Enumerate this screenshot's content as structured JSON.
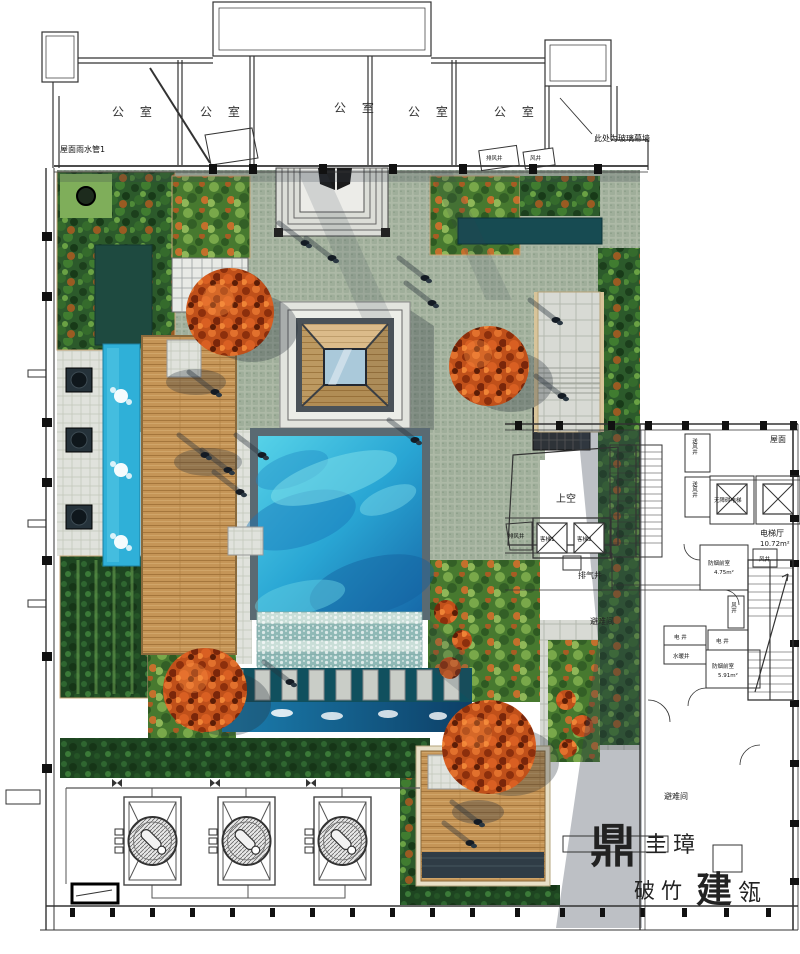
{
  "building_top": {
    "room_labels": [
      "公 室",
      "公 室",
      "公 室",
      "公 室",
      "公 室"
    ],
    "rain_pipe_note": "屋面雨水管1",
    "curtain_wall_note": "此处为玻璃幕墙",
    "vent_box_labels": [
      "排风井",
      "风井"
    ]
  },
  "plan": {
    "roof": "屋面",
    "void": "上空",
    "supply_shafts": [
      "送风井",
      "送风井"
    ],
    "exhaust_shaft": "排风井",
    "exhaust_air": "排气井",
    "elevators": [
      "客梯1",
      "客梯2"
    ],
    "accessible_elevator": "无障碍电梯",
    "lobby_name": "电梯厅",
    "lobby_area": "10.72m²",
    "smoke1_name": "防烟前室",
    "smoke1_area": "4.75m²",
    "smoke2_name": "防烟前室",
    "smoke2_area": "5.91m²",
    "wind_shafts": [
      "风井",
      "风井"
    ],
    "electric_shafts": [
      "电 井",
      "电 井"
    ],
    "plumbing_shaft": "水暖井",
    "refuge_rooms": [
      "避难间",
      "避难间"
    ]
  },
  "watermark": {
    "seal": "鼎",
    "name": "圭璋",
    "phrase1": "破竹",
    "phrase_red": "建",
    "phrase2": "瓴"
  },
  "palette": {
    "pool_light": "#56d2e8",
    "pool_deep": "#1668a8",
    "channel": "#2fb0d8",
    "canal_deep": "#0d3f66",
    "tree_red": "#c0501a",
    "plant_dark": "#2c5a2b",
    "cobble": "#a9b6a3",
    "wood": "#c59557",
    "watermark_red": "#c42718"
  }
}
